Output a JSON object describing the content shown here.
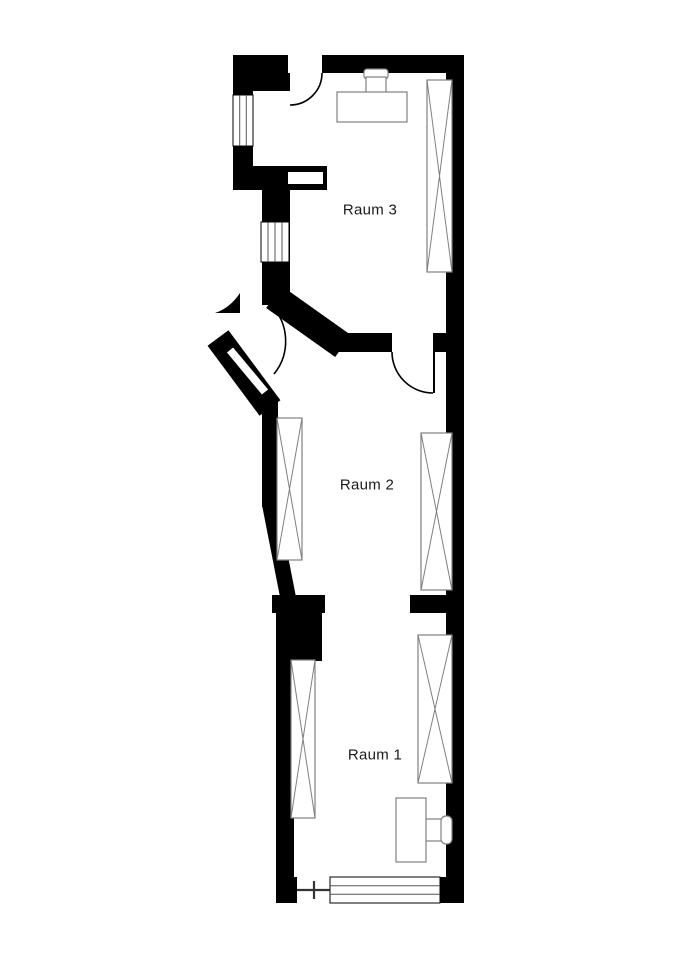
{
  "plan": {
    "rooms": [
      {
        "id": "raum-3",
        "label": "Raum 3"
      },
      {
        "id": "raum-2",
        "label": "Raum 2"
      },
      {
        "id": "raum-1",
        "label": "Raum 1"
      }
    ]
  },
  "colors": {
    "wall": "#000000",
    "furniture": "#808080",
    "background": "#ffffff",
    "text": "#1a1a1a"
  }
}
